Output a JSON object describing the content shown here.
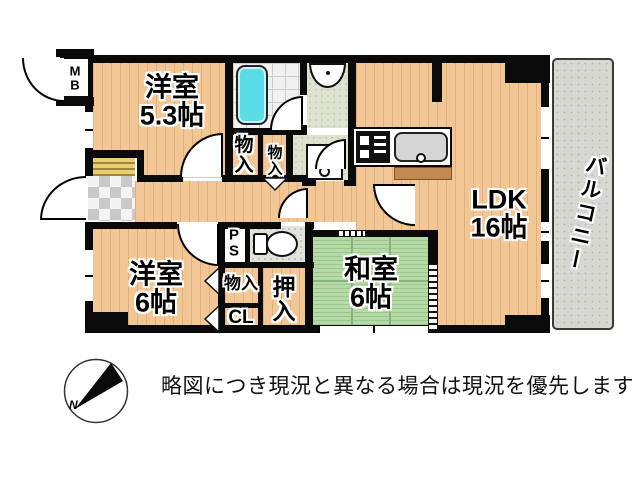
{
  "rooms": {
    "w53": {
      "name": "洋室",
      "size": "5.3帖"
    },
    "w6": {
      "name": "洋室",
      "size": "6帖"
    },
    "ldk": {
      "name": "LDK",
      "size": "16帖"
    },
    "washitsu": {
      "name": "和室",
      "size": "6帖"
    },
    "balcony": {
      "name": "バルコニー"
    }
  },
  "closets": {
    "monoire1": "物入",
    "monoire2": "物入",
    "monoire3": "物入",
    "oshiire": "押入",
    "cl": "CL",
    "ps": "PS",
    "mb": "MB"
  },
  "compass": {
    "north": "N"
  },
  "disclaimer": {
    "text": "略図につき現況と異なる場合は現況を優先します"
  },
  "colors": {
    "wall": "#0a0a0a",
    "wood_floor": "#f2c795",
    "tatami": "#b5daa6",
    "bathtub": "#5adde6",
    "balcony_floor": "#d8d8d2",
    "entrance_mat": "#e7cf72"
  }
}
